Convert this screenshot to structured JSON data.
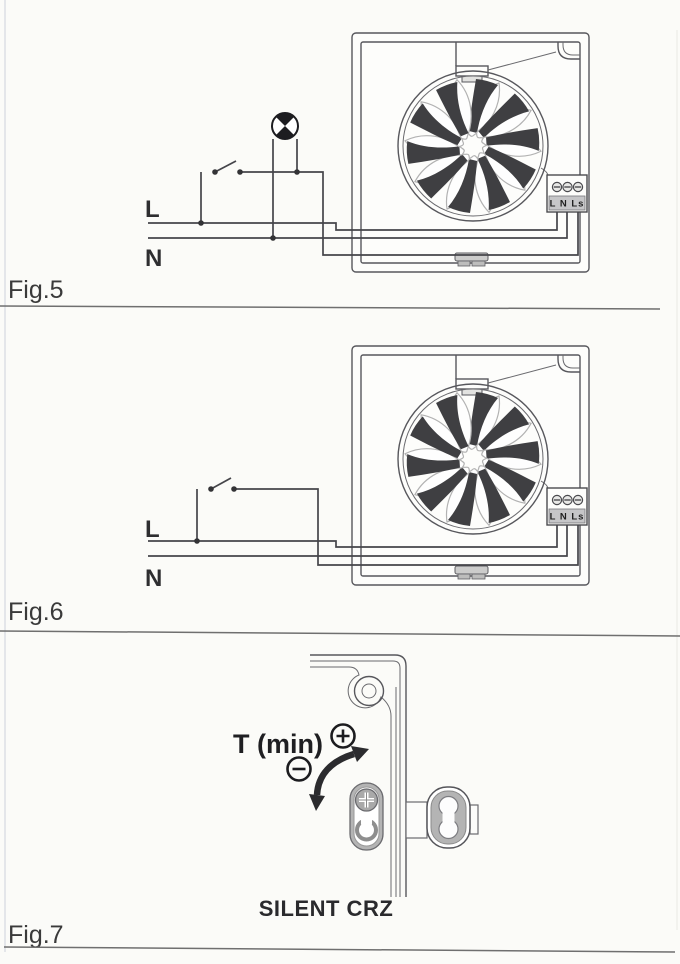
{
  "page": {
    "paper_color": "#fbfbf8",
    "ink_color": "#3f3f42",
    "metal_gray": "#b4b4b4"
  },
  "fig5": {
    "label": "Fig.5",
    "live_label": "L",
    "neutral_label": "N",
    "terminal_labels": "L N Ls"
  },
  "fig6": {
    "label": "Fig.6",
    "live_label": "L",
    "neutral_label": "N",
    "terminal_labels": "L N Ls"
  },
  "fig7": {
    "label": "Fig.7",
    "timer_label": "T (min)",
    "caption": "SILENT CRZ",
    "icons": {
      "plus": "⊕",
      "minus": "⊖"
    }
  }
}
